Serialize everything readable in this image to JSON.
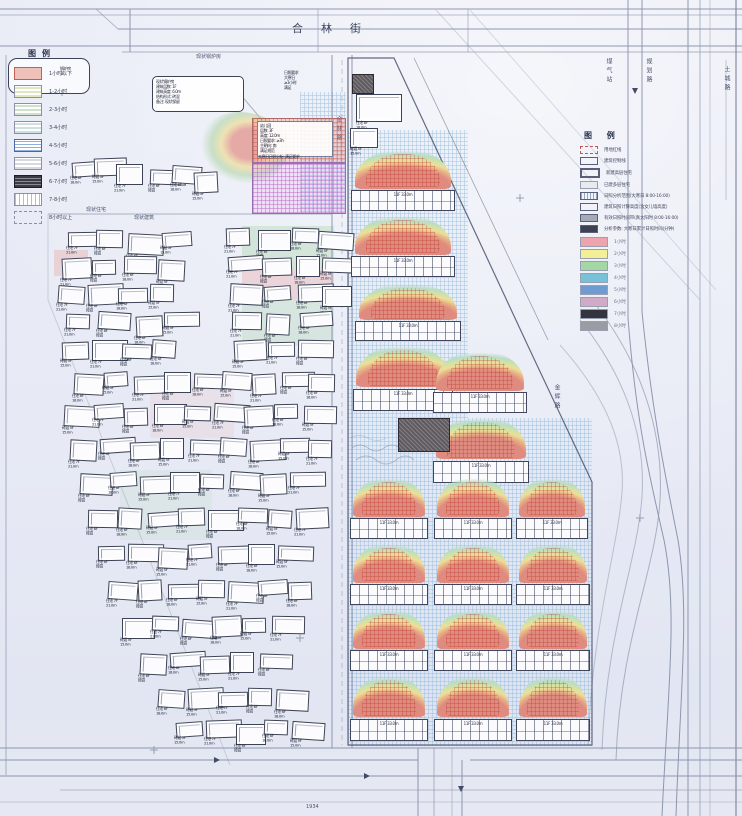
{
  "streets": {
    "top": "合林街"
  },
  "road_labels": [
    {
      "text": "金林路",
      "x": 334,
      "y": 116,
      "vertical": true
    },
    {
      "text": "煤气站",
      "x": 604,
      "y": 58,
      "vertical": true
    },
    {
      "text": "规划路",
      "x": 644,
      "y": 58,
      "vertical": true
    },
    {
      "text": "土城路",
      "x": 722,
      "y": 66,
      "vertical": true
    },
    {
      "text": "金辉路",
      "x": 552,
      "y": 384,
      "vertical": true
    },
    {
      "text": "现状住宅",
      "x": 86,
      "y": 206,
      "vertical": false
    },
    {
      "text": "现状建筑",
      "x": 134,
      "y": 214,
      "vertical": false
    },
    {
      "text": "现状锅炉房",
      "x": 196,
      "y": 53,
      "vertical": false
    },
    {
      "text": "1934",
      "x": 306,
      "y": 804,
      "vertical": false
    }
  ],
  "legend_left": {
    "title": "图例",
    "items": [
      {
        "label": "1小时以下",
        "type": "salmon"
      },
      {
        "label": "1-2小时",
        "type": "lines-yellowgreen"
      },
      {
        "label": "2-3小时",
        "type": "lines-green"
      },
      {
        "label": "3-4小时",
        "type": "lines-cyan"
      },
      {
        "label": "4-5小时",
        "type": "grid-blue"
      },
      {
        "label": "5-6小时",
        "type": "lines-gray"
      },
      {
        "label": "6-7小时",
        "type": "grid-dark"
      },
      {
        "label": "7-8小时",
        "type": "hatch-white"
      },
      {
        "label": "8小时以上",
        "type": "dash-white"
      }
    ]
  },
  "legend_right": {
    "title": "图 例",
    "symbol_items": [
      {
        "label": "用地红线",
        "sym": "dash-red"
      },
      {
        "label": "建筑控制线",
        "sym": "outline"
      },
      {
        "label": "新建高层住宅",
        "sym": "outline-thick"
      },
      {
        "label": "已建多层住宅",
        "sym": "outline-gray"
      },
      {
        "label": "日照分析范围(大寒日 8:00-16:00)",
        "sym": "grid"
      },
      {
        "label": "建筑日照计算高度(含女儿墙高度)",
        "sym": "outline"
      },
      {
        "label": "有效日照时间带(真太阳时 8:00-16:00)",
        "sym": "fill-gray"
      },
      {
        "label": "分析参数: 大寒日累计日照时间(分钟)",
        "sym": "fill-dark"
      }
    ],
    "color_items": [
      {
        "label": "1小时",
        "color": "#efa3ae"
      },
      {
        "label": "2小时",
        "color": "#f3ef93"
      },
      {
        "label": "3小时",
        "color": "#a4d8a2"
      },
      {
        "label": "4小时",
        "color": "#74c3da"
      },
      {
        "label": "5小时",
        "color": "#6d9bd6"
      },
      {
        "label": "6小时",
        "color": "#d2aac9"
      },
      {
        "label": "7小时",
        "color": "#34343f"
      },
      {
        "label": "8小时",
        "color": "#9a9ca4"
      }
    ]
  },
  "kindergarten": {
    "callout_lines": [
      "现状锅炉房",
      "建筑层数: 1F",
      "建筑高度: 6.0m",
      "结构形式: 砖混",
      "备注: 现状保留"
    ],
    "side_lines": [
      "日照要求",
      "大寒日",
      "≥3小时",
      "满足"
    ],
    "box_lines": [
      "幼儿园",
      "层数: 3F",
      "高度: 12.0m",
      "日照要求: ≥3h",
      "主朝向: 南",
      "满足规范"
    ],
    "box_caption": "大寒日日照分析: 满足要求"
  },
  "building_tags": [
    "住宅 6F\n18.0m",
    "砖混 5F\n15.0m",
    "住宅 7F\n21.0m",
    "住宅 6F\n砖混"
  ],
  "slab_tag": "11F 33.0m",
  "left_cluster": {
    "buildings": [
      [
        72,
        162
      ],
      [
        94,
        158
      ],
      [
        116,
        164
      ],
      [
        150,
        170
      ],
      [
        172,
        166
      ],
      [
        194,
        172
      ],
      [
        68,
        232
      ],
      [
        96,
        230
      ],
      [
        128,
        234
      ],
      [
        162,
        232
      ],
      [
        226,
        228
      ],
      [
        258,
        230
      ],
      [
        292,
        228
      ],
      [
        318,
        232
      ],
      [
        62,
        258
      ],
      [
        92,
        260
      ],
      [
        124,
        256
      ],
      [
        158,
        260
      ],
      [
        228,
        256
      ],
      [
        262,
        258
      ],
      [
        296,
        256
      ],
      [
        322,
        258
      ],
      [
        58,
        286
      ],
      [
        88,
        284
      ],
      [
        118,
        288
      ],
      [
        150,
        284
      ],
      [
        230,
        284
      ],
      [
        264,
        286
      ],
      [
        298,
        284
      ],
      [
        322,
        286
      ],
      [
        66,
        314
      ],
      [
        98,
        312
      ],
      [
        136,
        316
      ],
      [
        164,
        312
      ],
      [
        232,
        312
      ],
      [
        266,
        314
      ],
      [
        300,
        312
      ],
      [
        62,
        342
      ],
      [
        92,
        340
      ],
      [
        122,
        344
      ],
      [
        152,
        340
      ],
      [
        234,
        340
      ],
      [
        268,
        342
      ],
      [
        298,
        340
      ],
      [
        74,
        374
      ],
      [
        104,
        372
      ],
      [
        134,
        376
      ],
      [
        164,
        372
      ],
      [
        194,
        374
      ],
      [
        222,
        372
      ],
      [
        252,
        374
      ],
      [
        282,
        372
      ],
      [
        308,
        374
      ],
      [
        64,
        406
      ],
      [
        94,
        404
      ],
      [
        124,
        408
      ],
      [
        154,
        404
      ],
      [
        184,
        406
      ],
      [
        214,
        404
      ],
      [
        244,
        406
      ],
      [
        274,
        404
      ],
      [
        304,
        406
      ],
      [
        70,
        440
      ],
      [
        100,
        438
      ],
      [
        130,
        442
      ],
      [
        160,
        438
      ],
      [
        190,
        440
      ],
      [
        220,
        438
      ],
      [
        250,
        440
      ],
      [
        280,
        438
      ],
      [
        308,
        440
      ],
      [
        80,
        474
      ],
      [
        110,
        472
      ],
      [
        140,
        476
      ],
      [
        170,
        472
      ],
      [
        200,
        474
      ],
      [
        230,
        472
      ],
      [
        260,
        474
      ],
      [
        290,
        472
      ],
      [
        88,
        510
      ],
      [
        118,
        508
      ],
      [
        148,
        512
      ],
      [
        178,
        508
      ],
      [
        208,
        510
      ],
      [
        238,
        508
      ],
      [
        268,
        510
      ],
      [
        296,
        508
      ],
      [
        98,
        546
      ],
      [
        128,
        544
      ],
      [
        158,
        548
      ],
      [
        188,
        544
      ],
      [
        218,
        546
      ],
      [
        248,
        544
      ],
      [
        278,
        546
      ],
      [
        108,
        582
      ],
      [
        138,
        580
      ],
      [
        168,
        584
      ],
      [
        198,
        580
      ],
      [
        228,
        582
      ],
      [
        258,
        580
      ],
      [
        288,
        582
      ],
      [
        122,
        618
      ],
      [
        152,
        616
      ],
      [
        182,
        620
      ],
      [
        212,
        616
      ],
      [
        242,
        618
      ],
      [
        272,
        616
      ],
      [
        140,
        654
      ],
      [
        170,
        652
      ],
      [
        200,
        656
      ],
      [
        230,
        652
      ],
      [
        260,
        654
      ],
      [
        158,
        690
      ],
      [
        188,
        688
      ],
      [
        218,
        692
      ],
      [
        248,
        688
      ],
      [
        276,
        690
      ],
      [
        176,
        722
      ],
      [
        206,
        720
      ],
      [
        236,
        724
      ],
      [
        264,
        720
      ],
      [
        292,
        722
      ]
    ]
  },
  "parcel": {
    "units": [
      [
        348,
        148,
        110,
        66
      ],
      [
        348,
        214,
        110,
        66
      ],
      [
        352,
        282,
        112,
        62
      ],
      [
        350,
        344,
        106,
        70
      ],
      [
        430,
        350,
        100,
        66
      ],
      [
        430,
        416,
        102,
        70
      ],
      [
        348,
        476,
        82,
        66
      ],
      [
        432,
        476,
        82,
        66
      ],
      [
        514,
        476,
        76,
        66
      ],
      [
        348,
        542,
        82,
        66
      ],
      [
        432,
        542,
        82,
        66
      ],
      [
        514,
        542,
        78,
        66
      ],
      [
        348,
        608,
        82,
        66
      ],
      [
        432,
        608,
        82,
        66
      ],
      [
        514,
        608,
        78,
        66
      ],
      [
        348,
        674,
        82,
        70
      ],
      [
        432,
        674,
        82,
        70
      ],
      [
        514,
        674,
        78,
        70
      ]
    ],
    "dark_buildings": [
      [
        352,
        74,
        20,
        18
      ],
      [
        398,
        418,
        50,
        32
      ]
    ],
    "top_buildings": [
      [
        356,
        94,
        44,
        26
      ],
      [
        350,
        128,
        26,
        18
      ]
    ]
  }
}
